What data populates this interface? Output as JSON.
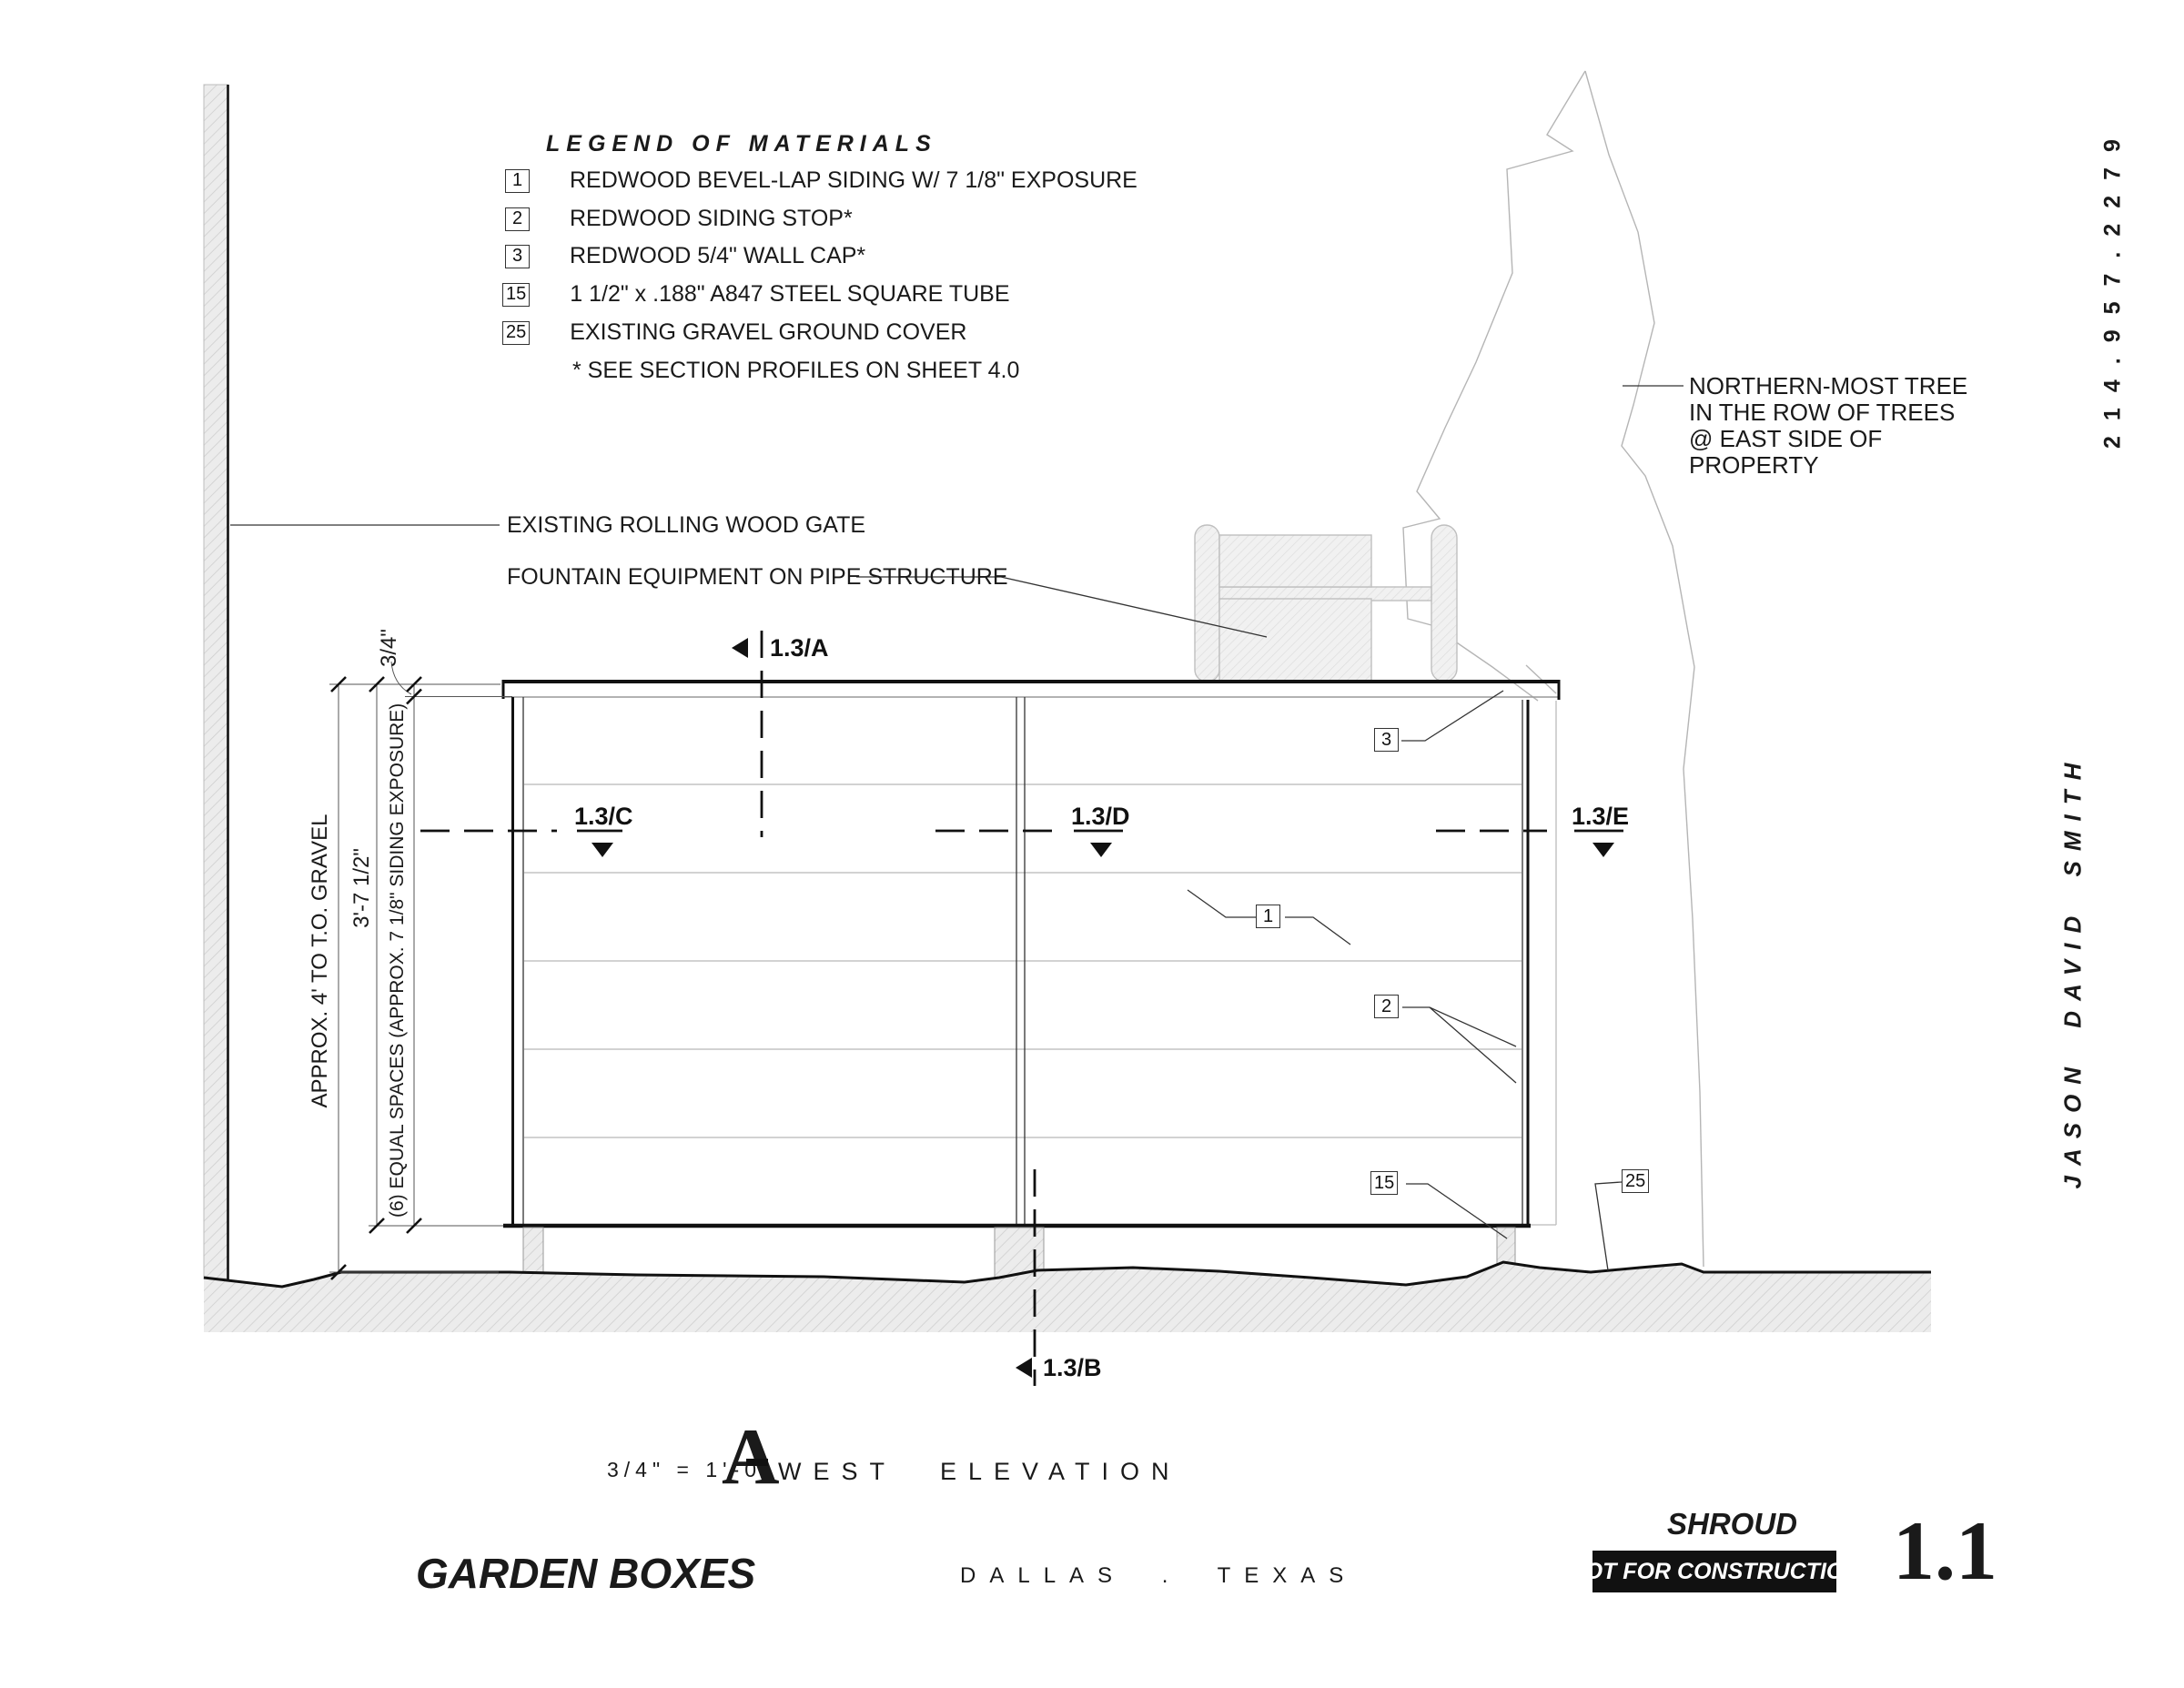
{
  "sheet": {
    "legend": {
      "title": "LEGEND OF MATERIALS",
      "items": [
        {
          "key": "1",
          "label": "REDWOOD BEVEL-LAP SIDING W/ 7 1/8\" EXPOSURE"
        },
        {
          "key": "2",
          "label": "REDWOOD SIDING STOP*"
        },
        {
          "key": "3",
          "label": "REDWOOD 5/4\" WALL CAP*"
        },
        {
          "key": "15",
          "label": "1 1/2\" x .188\" A847 STEEL SQUARE TUBE"
        },
        {
          "key": "25",
          "label": "EXISTING GRAVEL GROUND COVER"
        }
      ],
      "note": "* SEE SECTION PROFILES ON SHEET 4.0"
    },
    "annotations": {
      "gate": "EXISTING ROLLING WOOD GATE",
      "fountain": "FOUNTAIN EQUIPMENT ON PIPE STRUCTURE",
      "tree_note_lines": [
        "NORTHERN-MOST TREE",
        "IN THE ROW OF TREES",
        "@ EAST SIDE OF",
        "PROPERTY"
      ]
    },
    "dimensions": {
      "overall": "APPROX. 4' TO T.O. GRAVEL",
      "height": "3'-7 1/2\"",
      "spaces": "(6) EQUAL SPACES (APPROX. 7 1/8\" SIDING EXPOSURE)",
      "cap": "3/4\""
    },
    "section_markers": {
      "a": "1.3/A",
      "b": "1.3/B",
      "c": "1.3/C",
      "d": "1.3/D",
      "e": "1.3/E"
    },
    "callouts": {
      "c1": "1",
      "c2": "2",
      "c3": "3",
      "c15": "15",
      "c25": "25"
    },
    "titleblock": {
      "scale": "3/4\" = 1'-0\"",
      "marker_letter": "A",
      "view_title": "WEST ELEVATION",
      "project": "GARDEN BOXES",
      "location": "DALLAS . TEXAS",
      "firm": "SHROUD",
      "status": "NOT FOR CONSTRUCTION",
      "sheet_number": "1.1",
      "phone": "214.957.2279",
      "architect": "JASON DAVID SMITH"
    },
    "colors": {
      "ink": "#1a1a1a",
      "light_line": "#c4c4c4",
      "hatch": "#d9d9d9"
    }
  }
}
